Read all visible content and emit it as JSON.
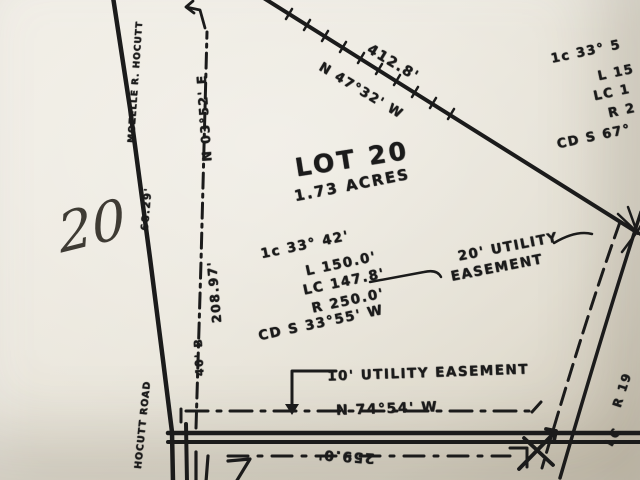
{
  "colors": {
    "paper": "#e9e5da",
    "ink": "#1b1b1b",
    "pencil": "#302c26"
  },
  "handwritten_note": "20",
  "lot": {
    "name": "LOT 20",
    "area": "1.73 ACRES"
  },
  "north_boundary": {
    "distance": "412.8'",
    "bearing": "N 47°32' W"
  },
  "west_line": {
    "bearing": "N 03°52' E",
    "distance": "208.97'",
    "setback": "40' B"
  },
  "south_line": {
    "bearing": "N 74°54' W",
    "street_distance": "259.0'"
  },
  "easements": {
    "east_label_line1": "20' UTILITY",
    "east_label_line2": "EASEMENT",
    "south_label": "10' UTILITY EASEMENT"
  },
  "curves": {
    "west": [
      "1c 33° 42'",
      "L 150.0'",
      "LC 147.8'",
      "R 250.0'",
      "CD S 33°55' W"
    ],
    "east": [
      "1c 33° 5",
      "L 15",
      "LC 1",
      "R 2",
      "CD S 67°"
    ],
    "southeast": [
      "R 19",
      "LC"
    ]
  },
  "road": {
    "owner": "MOZELLE R. HOCUTT",
    "tie_distance": "68.29'",
    "name": "HOCUTT ROAD"
  }
}
